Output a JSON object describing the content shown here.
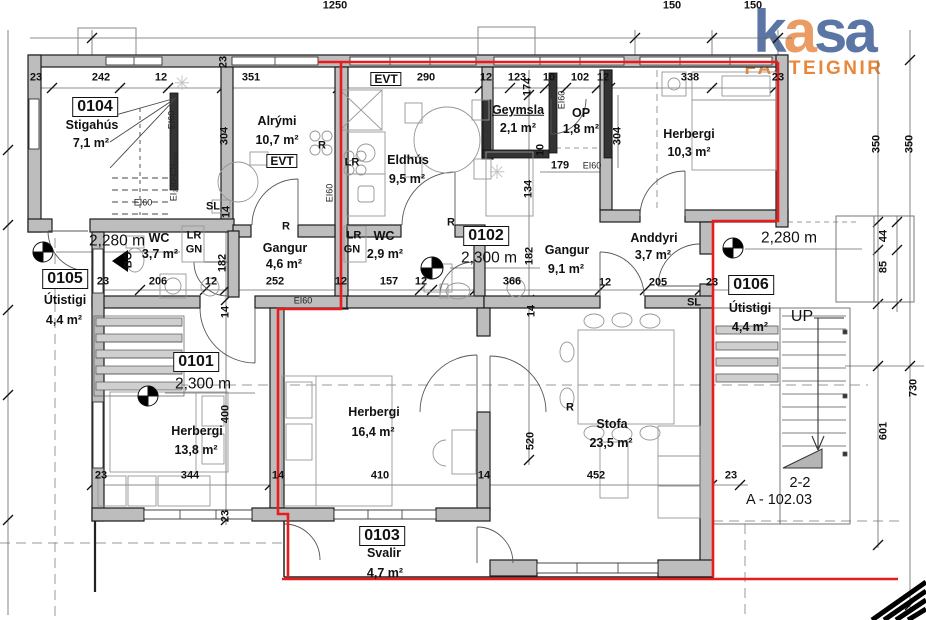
{
  "logo": {
    "letters": [
      {
        "ch": "k",
        "color": "#5b76a4"
      },
      {
        "ch": "a",
        "color": "#eb9c64"
      },
      {
        "ch": "s",
        "color": "#5b76a4"
      },
      {
        "ch": "a",
        "color": "#5b76a4"
      }
    ],
    "subtitle": "FASTEIGNIR",
    "subtitle_color": "#e8873b"
  },
  "colors": {
    "escape_route_red": "#e81c1c",
    "wall_fill": "#bdbdbd",
    "dark_wall": "#333333",
    "logo_blue": "#5b76a4",
    "logo_orange": "#eb9c64"
  },
  "drawing_reference": {
    "section_mark": "2-2",
    "sheet": "A - 102.03"
  },
  "units": [
    {
      "tag": "0101",
      "value": "2,300 m"
    },
    {
      "tag": "0102",
      "value": "2,300 m"
    },
    {
      "tag": "0103",
      "name": "Svalir",
      "area": "4,7 m²"
    },
    {
      "tag": "0104",
      "name": "Stigahús",
      "area": "7,1 m²"
    },
    {
      "tag": "0105",
      "name": "Útistigi",
      "area": "4,4 m²"
    },
    {
      "tag": "0106",
      "name": "Útistigi",
      "area": "4,4 m²"
    }
  ],
  "plan": {
    "labels": [
      {
        "t": "1250",
        "x": 335,
        "y": 6
      },
      {
        "t": "150",
        "x": 672,
        "y": 6
      },
      {
        "t": "150",
        "x": 753,
        "y": 6
      },
      {
        "t": "23",
        "x": 36,
        "y": 78
      },
      {
        "t": "242",
        "x": 101,
        "y": 78
      },
      {
        "t": "12",
        "x": 161,
        "y": 78
      },
      {
        "t": "351",
        "x": 251,
        "y": 78
      },
      {
        "t": "290",
        "x": 426,
        "y": 78
      },
      {
        "t": "12",
        "x": 486,
        "y": 78
      },
      {
        "t": "123",
        "x": 517,
        "y": 78
      },
      {
        "t": "10",
        "x": 549,
        "y": 78
      },
      {
        "t": "102",
        "x": 580,
        "y": 78
      },
      {
        "t": "12",
        "x": 603,
        "y": 78
      },
      {
        "t": "338",
        "x": 690,
        "y": 78
      },
      {
        "t": "23",
        "x": 778,
        "y": 78
      },
      {
        "t": "23",
        "x": 224,
        "y": 62,
        "r": -90
      },
      {
        "t": "304",
        "x": 225,
        "y": 136,
        "r": -90
      },
      {
        "t": "182",
        "x": 223,
        "y": 263,
        "r": -90
      },
      {
        "t": "14",
        "x": 227,
        "y": 212,
        "r": -90
      },
      {
        "t": "14",
        "x": 226,
        "y": 312,
        "r": -90
      },
      {
        "t": "400",
        "x": 226,
        "y": 414,
        "r": -90
      },
      {
        "t": "23",
        "x": 226,
        "y": 516,
        "r": -90
      },
      {
        "t": "174",
        "x": 528,
        "y": 87,
        "r": -90
      },
      {
        "t": "10",
        "x": 541,
        "y": 150,
        "r": -90
      },
      {
        "t": "134",
        "x": 529,
        "y": 189,
        "r": -90
      },
      {
        "t": "182",
        "x": 530,
        "y": 256,
        "r": -90
      },
      {
        "t": "14",
        "x": 532,
        "y": 311,
        "r": -90
      },
      {
        "t": "520",
        "x": 531,
        "y": 441,
        "r": -90
      },
      {
        "t": "304",
        "x": 618,
        "y": 136,
        "r": -90
      },
      {
        "t": "350",
        "x": 877,
        "y": 144,
        "r": -90
      },
      {
        "t": "350",
        "x": 910,
        "y": 144,
        "r": -90
      },
      {
        "t": "44",
        "x": 884,
        "y": 236,
        "r": -90
      },
      {
        "t": "85",
        "x": 884,
        "y": 267,
        "r": -90
      },
      {
        "t": "601",
        "x": 884,
        "y": 431,
        "r": -90
      },
      {
        "t": "730",
        "x": 914,
        "y": 388,
        "r": -90
      },
      {
        "t": "23",
        "x": 103,
        "y": 282
      },
      {
        "t": "206",
        "x": 158,
        "y": 282
      },
      {
        "t": "12",
        "x": 211,
        "y": 282
      },
      {
        "t": "252",
        "x": 275,
        "y": 282
      },
      {
        "t": "12",
        "x": 341,
        "y": 282
      },
      {
        "t": "157",
        "x": 389,
        "y": 282
      },
      {
        "t": "12",
        "x": 421,
        "y": 282
      },
      {
        "t": "366",
        "x": 512,
        "y": 282
      },
      {
        "t": "12",
        "x": 605,
        "y": 283
      },
      {
        "t": "205",
        "x": 658,
        "y": 283
      },
      {
        "t": "23",
        "x": 712,
        "y": 283
      },
      {
        "t": "179",
        "x": 560,
        "y": 166
      },
      {
        "t": "23",
        "x": 101,
        "y": 476
      },
      {
        "t": "344",
        "x": 190,
        "y": 476
      },
      {
        "t": "14",
        "x": 278,
        "y": 476
      },
      {
        "t": "410",
        "x": 380,
        "y": 476
      },
      {
        "t": "14",
        "x": 484,
        "y": 476
      },
      {
        "t": "452",
        "x": 596,
        "y": 476
      },
      {
        "t": "23",
        "x": 731,
        "y": 476
      },
      {
        "t": "0104",
        "x": 95,
        "y": 107,
        "c": "tag",
        "n": "unit-tag-0104"
      },
      {
        "t": "Stigahús",
        "x": 92,
        "y": 125,
        "c": "room",
        "n": "room-stigahus"
      },
      {
        "t": "7,1 m²",
        "x": 91,
        "y": 143,
        "c": "room"
      },
      {
        "t": "Alrými",
        "x": 277,
        "y": 121,
        "c": "room",
        "n": "room-alrymi"
      },
      {
        "t": "10,7 m²",
        "x": 277,
        "y": 140,
        "c": "room"
      },
      {
        "t": "EVT",
        "x": 282,
        "y": 161,
        "c": "evt",
        "n": "evt-box"
      },
      {
        "t": "EVT",
        "x": 386,
        "y": 79,
        "c": "evt",
        "n": "evt-box"
      },
      {
        "t": "Eldhús",
        "x": 408,
        "y": 160,
        "c": "room",
        "n": "room-eldhus"
      },
      {
        "t": "9,5 m²",
        "x": 407,
        "y": 179,
        "c": "room"
      },
      {
        "t": "Geymsla",
        "x": 518,
        "y": 110,
        "c": "room u",
        "n": "room-geymsla"
      },
      {
        "t": "2,1 m²",
        "x": 518,
        "y": 128,
        "c": "room"
      },
      {
        "t": "OP",
        "x": 581,
        "y": 113,
        "c": "room",
        "n": "room-op"
      },
      {
        "t": "1,8 m²",
        "x": 581,
        "y": 129,
        "c": "room"
      },
      {
        "t": "Herbergi",
        "x": 689,
        "y": 134,
        "c": "room",
        "n": "room-herbergi-103"
      },
      {
        "t": "10,3 m²",
        "x": 689,
        "y": 152,
        "c": "room"
      },
      {
        "t": "WC",
        "x": 159,
        "y": 238,
        "c": "room",
        "n": "room-wc-37"
      },
      {
        "t": "3,7 m²",
        "x": 160,
        "y": 254,
        "c": "room"
      },
      {
        "t": "Gangur",
        "x": 285,
        "y": 248,
        "c": "room",
        "n": "room-gangur-46"
      },
      {
        "t": "4,6 m²",
        "x": 284,
        "y": 264,
        "c": "room"
      },
      {
        "t": "WC",
        "x": 384,
        "y": 236,
        "c": "room",
        "n": "room-wc-29"
      },
      {
        "t": "2,9 m²",
        "x": 385,
        "y": 254,
        "c": "room"
      },
      {
        "t": "Gangur",
        "x": 567,
        "y": 250,
        "c": "room",
        "n": "room-gangur-91"
      },
      {
        "t": "9,1 m²",
        "x": 566,
        "y": 269,
        "c": "room"
      },
      {
        "t": "Anddyri",
        "x": 654,
        "y": 238,
        "c": "room",
        "n": "room-anddyri"
      },
      {
        "t": "3,7 m²",
        "x": 653,
        "y": 255,
        "c": "room"
      },
      {
        "t": "0105",
        "x": 65,
        "y": 279,
        "c": "tag",
        "n": "unit-tag-0105"
      },
      {
        "t": "Útistigi",
        "x": 65,
        "y": 300,
        "c": "room",
        "n": "room-utistigi-left"
      },
      {
        "t": "4,4 m²",
        "x": 64,
        "y": 320,
        "c": "room"
      },
      {
        "t": "0106",
        "x": 751,
        "y": 285,
        "c": "tag",
        "n": "unit-tag-0106"
      },
      {
        "t": "Útistigi",
        "x": 750,
        "y": 308,
        "c": "room",
        "n": "room-utistigi-right"
      },
      {
        "t": "4,4 m²",
        "x": 750,
        "y": 327,
        "c": "room"
      },
      {
        "t": "0101",
        "x": 196,
        "y": 362,
        "c": "tag",
        "n": "unit-tag-0101"
      },
      {
        "t": "2,300 m",
        "x": 203,
        "y": 384,
        "c": "level",
        "n": "level-0101"
      },
      {
        "t": "0102",
        "x": 486,
        "y": 236,
        "c": "tag",
        "n": "unit-tag-0102"
      },
      {
        "t": "2,300 m",
        "x": 489,
        "y": 258,
        "c": "level",
        "n": "level-0102"
      },
      {
        "t": "Herbergi",
        "x": 197,
        "y": 431,
        "c": "room",
        "n": "room-herbergi-138"
      },
      {
        "t": "13,8 m²",
        "x": 196,
        "y": 450,
        "c": "room"
      },
      {
        "t": "Herbergi",
        "x": 374,
        "y": 412,
        "c": "room",
        "n": "room-herbergi-164"
      },
      {
        "t": "16,4 m²",
        "x": 373,
        "y": 432,
        "c": "room"
      },
      {
        "t": "Stofa",
        "x": 612,
        "y": 424,
        "c": "room",
        "n": "room-stofa"
      },
      {
        "t": "23,5 m²",
        "x": 611,
        "y": 443,
        "c": "room"
      },
      {
        "t": "0103",
        "x": 382,
        "y": 536,
        "c": "tag",
        "n": "unit-tag-0103"
      },
      {
        "t": "Svalir",
        "x": 384,
        "y": 553,
        "c": "room",
        "n": "room-svalir"
      },
      {
        "t": "4,7 m²",
        "x": 385,
        "y": 573,
        "c": "room"
      },
      {
        "t": "2,280 m",
        "x": 117,
        "y": 241,
        "c": "level",
        "n": "level-left"
      },
      {
        "t": "2,280 m",
        "x": 789,
        "y": 238,
        "c": "level",
        "n": "level-right"
      },
      {
        "t": "SL",
        "x": 213,
        "y": 207,
        "c": "small",
        "n": "sliding-door-label"
      },
      {
        "t": "SL",
        "x": 694,
        "y": 303,
        "c": "small",
        "n": "sliding-door-label"
      },
      {
        "t": "R",
        "x": 286,
        "y": 227,
        "c": "small",
        "n": "radiator-label"
      },
      {
        "t": "R",
        "x": 451,
        "y": 223,
        "c": "small",
        "n": "radiator-label"
      },
      {
        "t": "R",
        "x": 570,
        "y": 408,
        "c": "small",
        "n": "radiator-label"
      },
      {
        "t": "R",
        "x": 322,
        "y": 146,
        "c": "small",
        "n": "radiator-label"
      },
      {
        "t": "LR",
        "x": 352,
        "y": 163,
        "c": "small",
        "n": "lr-label"
      },
      {
        "t": "LR",
        "x": 194,
        "y": 236,
        "c": "small",
        "n": "lr-label"
      },
      {
        "t": "GN",
        "x": 194,
        "y": 250,
        "c": "small",
        "n": "gn-label"
      },
      {
        "t": "LR",
        "x": 354,
        "y": 236,
        "c": "small",
        "n": "lr-label"
      },
      {
        "t": "GN",
        "x": 352,
        "y": 250,
        "c": "small",
        "n": "gn-label"
      },
      {
        "t": "BO",
        "x": 129,
        "y": 260,
        "r": -90,
        "c": "small",
        "n": "bo-label"
      },
      {
        "t": "UP",
        "x": 802,
        "y": 317,
        "c": "up",
        "n": "stairs-up-label"
      },
      {
        "t": "EI60",
        "x": 172,
        "y": 120,
        "r": -90,
        "c": "ei",
        "n": "fire-rating-label"
      },
      {
        "t": "EI60",
        "x": 143,
        "y": 203,
        "c": "ei",
        "n": "fire-rating-label"
      },
      {
        "t": "EI60",
        "x": 330,
        "y": 193,
        "r": -90,
        "c": "ei",
        "n": "fire-rating-label"
      },
      {
        "t": "EI60",
        "x": 303,
        "y": 301,
        "c": "ei",
        "n": "fire-rating-label"
      },
      {
        "t": "EI60",
        "x": 562,
        "y": 100,
        "r": -90,
        "c": "ei",
        "n": "fire-rating-label"
      },
      {
        "t": "EI60",
        "x": 592,
        "y": 166,
        "c": "ei",
        "n": "fire-rating-label"
      },
      {
        "t": "EI₂30-CS₂₀₀",
        "x": 174,
        "y": 177,
        "r": -90,
        "c": "ei",
        "n": "fire-rating-label"
      },
      {
        "t": "2-2",
        "x": 800,
        "y": 483,
        "c": "section",
        "n": "section-mark"
      },
      {
        "t": "A - 102.03",
        "x": 779,
        "y": 500,
        "c": "section",
        "n": "sheet-reference"
      },
      {
        "t": "✳",
        "x": 182,
        "y": 84,
        "c": "ast",
        "n": "symbol-asterisk"
      },
      {
        "t": "✳",
        "x": 497,
        "y": 173,
        "c": "ast",
        "n": "symbol-asterisk"
      }
    ]
  }
}
